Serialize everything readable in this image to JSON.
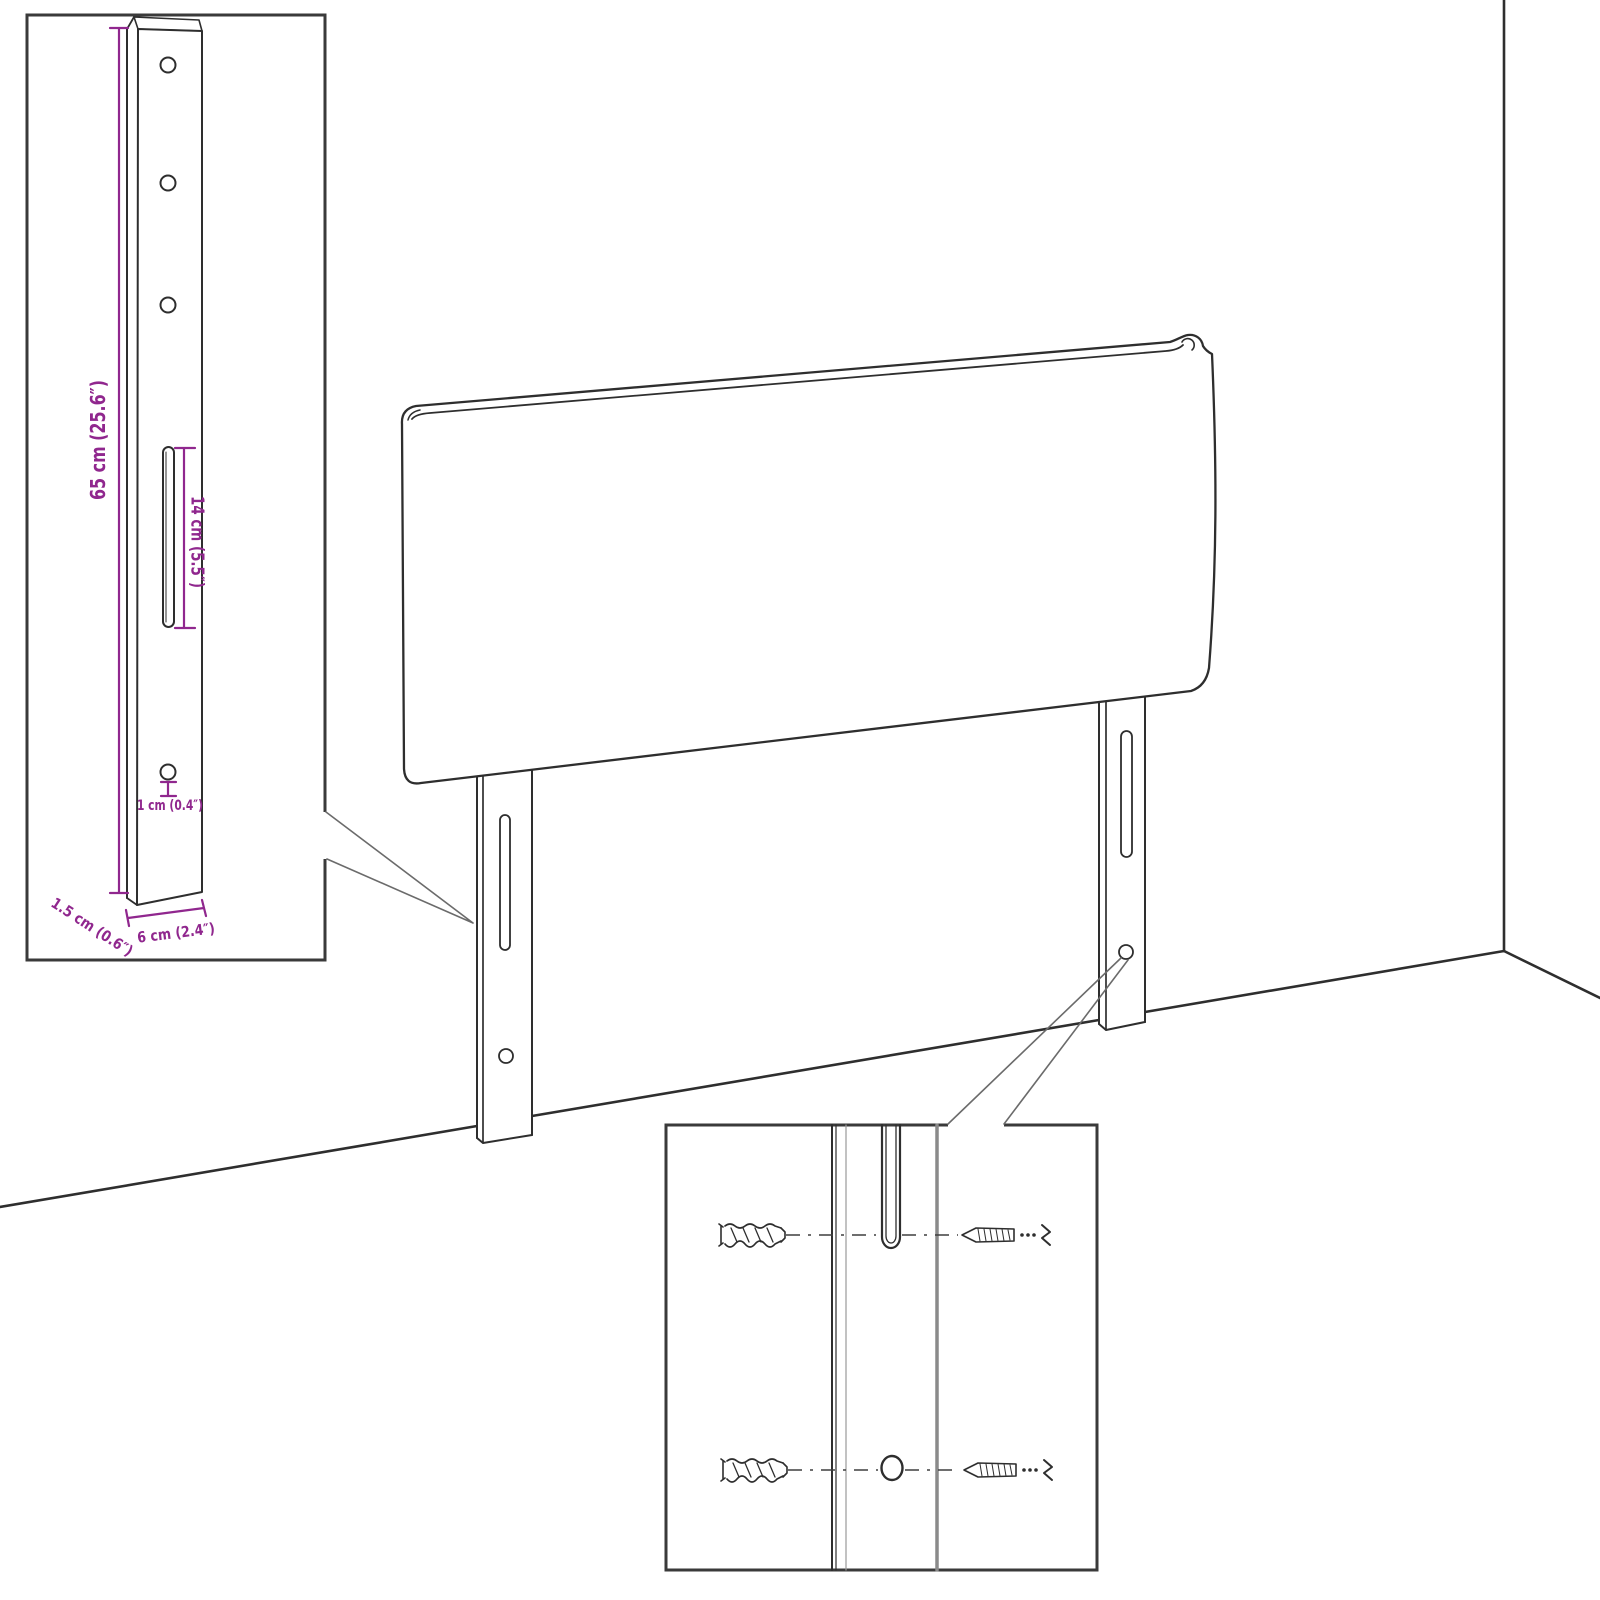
{
  "diagram": {
    "background": "#ffffff",
    "line_color": "#2e2e2e",
    "leader_color": "#6b6b6b",
    "accent_color": "#90278E",
    "labels": {
      "leg_height": "65 cm (25.6″)",
      "slot_length": "14 cm (5.5″)",
      "hole_diameter": "1 cm (0.4″)",
      "leg_depth": "1.5 cm (0.6″)",
      "leg_width": "6 cm (2.4″)"
    }
  }
}
